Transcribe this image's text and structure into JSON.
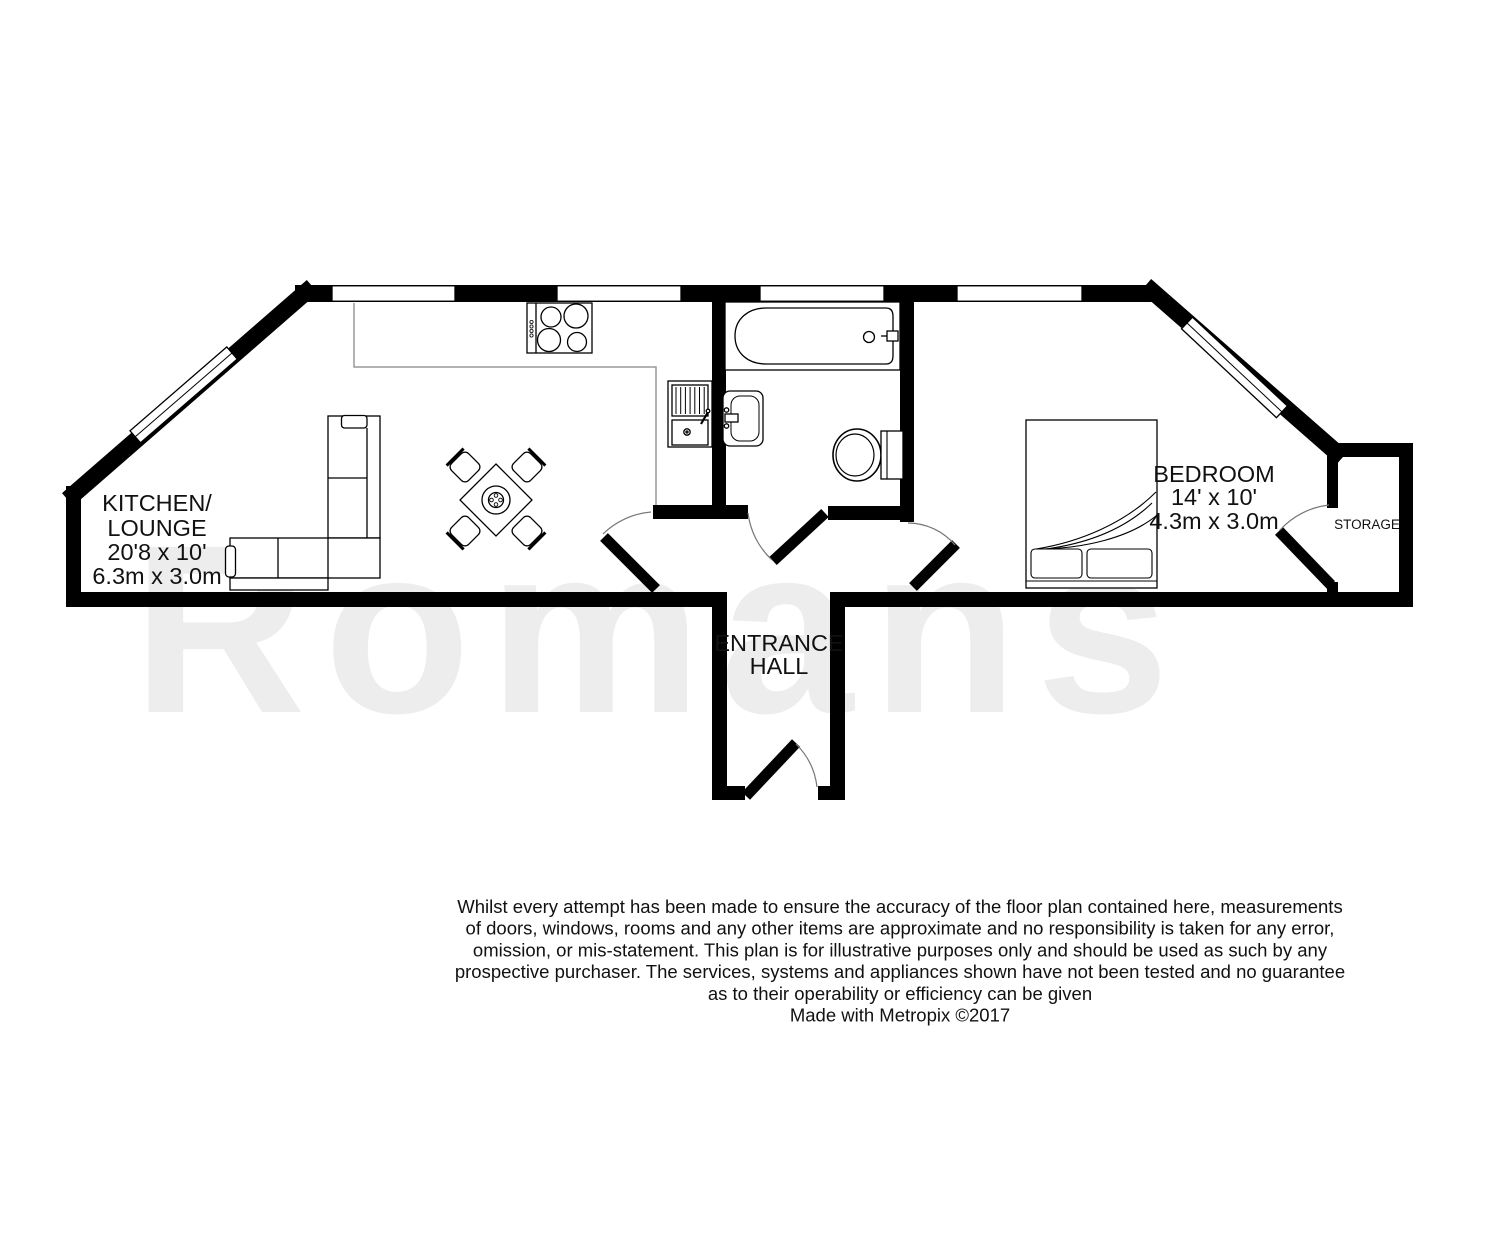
{
  "floorplan": {
    "watermark": "Romans",
    "rooms": {
      "kitchen_lounge": {
        "name_line1": "KITCHEN/",
        "name_line2": "LOUNGE",
        "dims_imperial": "20'8 x 10'",
        "dims_metric": "6.3m x 3.0m"
      },
      "bedroom": {
        "name": "BEDROOM",
        "dims_imperial": "14' x 10'",
        "dims_metric": "4.3m x 3.0m"
      },
      "storage": {
        "name": "STORAGE"
      },
      "entrance_hall": {
        "name_line1": "ENTRANCE",
        "name_line2": "HALL"
      }
    }
  },
  "disclaimer": {
    "lines": [
      "Whilst every attempt has been made to ensure the accuracy of the floor plan contained here, measurements",
      "of doors, windows, rooms and any other items are approximate and no responsibility is taken for any error,",
      "omission, or mis-statement. This plan is for illustrative purposes only and should be used as such by any",
      "prospective purchaser. The services, systems and appliances shown have not been tested and no guarantee",
      "as to their operability or efficiency can be given"
    ],
    "credit": "Made with Metropix ©2017"
  },
  "colors": {
    "walls": "#000000",
    "text": "#111111",
    "counter": "#999999",
    "watermark": "#ededed"
  }
}
